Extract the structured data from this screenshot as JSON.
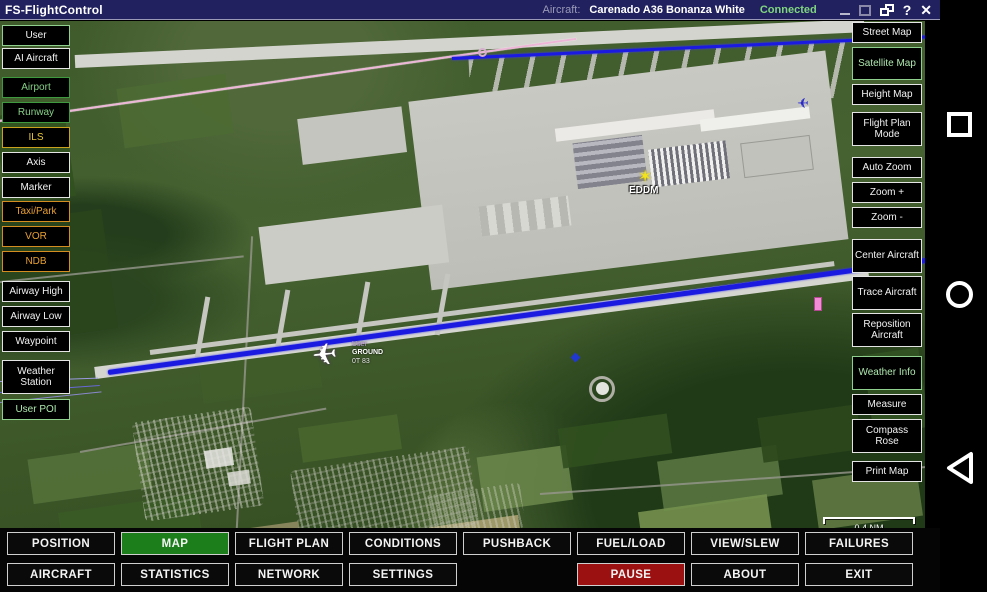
{
  "title_bar": {
    "app_name": "FS-FlightControl",
    "aircraft_label": "Aircraft:",
    "aircraft_name": "Carenado A36 Bonanza White",
    "connection_status": "Connected",
    "help_label": "?",
    "close_label": "✕"
  },
  "left_sidebar": {
    "items": [
      {
        "label": "User"
      },
      {
        "label": "AI Aircraft"
      },
      {
        "label": "Airport"
      },
      {
        "label": "Runway"
      },
      {
        "label": "ILS"
      },
      {
        "label": "Axis"
      },
      {
        "label": "Marker"
      },
      {
        "label": "Taxi/Park"
      },
      {
        "label": "VOR"
      },
      {
        "label": "NDB"
      },
      {
        "label": "Airway High"
      },
      {
        "label": "Airway Low"
      },
      {
        "label": "Waypoint"
      },
      {
        "label": "Weather Station"
      },
      {
        "label": "User POI"
      }
    ]
  },
  "right_sidebar": {
    "items": [
      {
        "label": "Street Map"
      },
      {
        "label": "Satellite Map"
      },
      {
        "label": "Height Map"
      },
      {
        "label": "Flight Plan Mode"
      },
      {
        "label": "Auto Zoom"
      },
      {
        "label": "Zoom +"
      },
      {
        "label": "Zoom -"
      },
      {
        "label": "Center Aircraft"
      },
      {
        "label": "Trace Aircraft"
      },
      {
        "label": "Reposition Aircraft"
      },
      {
        "label": "Weather Info"
      },
      {
        "label": "Measure"
      },
      {
        "label": "Compass Rose"
      },
      {
        "label": "Print Map"
      }
    ]
  },
  "map": {
    "airport_code": "EDDM",
    "star_glyph": "✶",
    "plane_glyph": "✈",
    "aircraft_tag": {
      "line1": "User",
      "line2": "GROUND",
      "line3": "0T 83"
    },
    "scale_label": "0.4 NM",
    "attribution": "©2016 Microsoft Corporation, ©2016 NAVTEQ, ©2016 Image courtesy of NASA"
  },
  "bottom_bar": {
    "row1": [
      {
        "label": "POSITION"
      },
      {
        "label": "MAP"
      },
      {
        "label": "FLIGHT PLAN"
      },
      {
        "label": "CONDITIONS"
      },
      {
        "label": "PUSHBACK"
      },
      {
        "label": "FUEL/LOAD"
      },
      {
        "label": "VIEW/SLEW"
      },
      {
        "label": "FAILURES"
      }
    ],
    "row2": [
      {
        "label": "AIRCRAFT"
      },
      {
        "label": "STATISTICS"
      },
      {
        "label": "NETWORK"
      },
      {
        "label": "SETTINGS"
      },
      {
        "label": "PAUSE"
      },
      {
        "label": "ABOUT"
      },
      {
        "label": "EXIT"
      }
    ]
  },
  "colors": {
    "titlebar_blue": "#21215f",
    "selected_tab_green": "#1b7e1b",
    "pause_red": "#9b1111",
    "connected_green": "#7fd67f",
    "layer_green": "#86d086",
    "layer_yellow": "#e8c73a",
    "layer_orange": "#e8a030",
    "runway_line_blue": "#1a1ae0",
    "trace_pink": "#ecb6d6"
  }
}
